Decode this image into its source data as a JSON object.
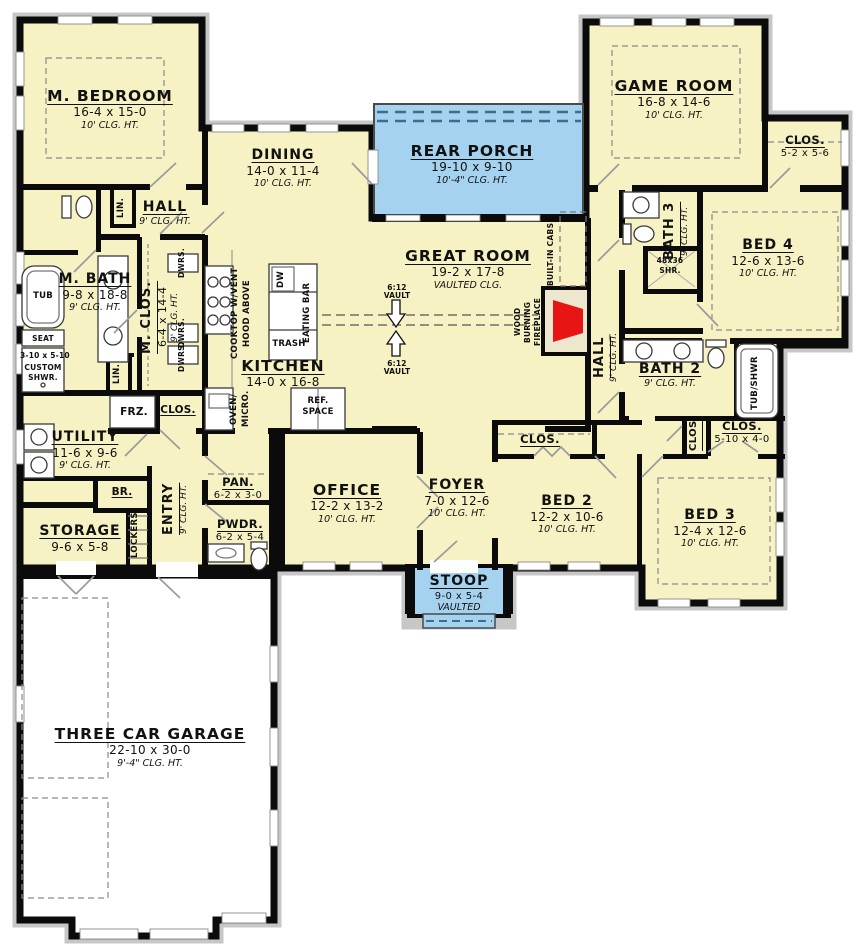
{
  "palette": {
    "background": "#ffffff",
    "floor": "#f6f2c3",
    "porch": "#a5d2ef",
    "wall": "#0b0b0b",
    "fireplace_red": "#e81515",
    "hearth": "#ece7cd",
    "door_line": "#9a9a9a",
    "exterior_floor": "#ffffff",
    "siding": "#c7c7c7"
  },
  "rooms": {
    "m_bedroom": {
      "name": "M. BEDROOM",
      "dims": "16-4 x 15-0",
      "clg": "10' CLG. HT."
    },
    "dining": {
      "name": "DINING",
      "dims": "14-0 x 11-4",
      "clg": "10' CLG. HT."
    },
    "rear_porch": {
      "name": "REAR PORCH",
      "dims": "19-10 x 9-10",
      "clg": "10'-4\" CLG. HT."
    },
    "game_room": {
      "name": "GAME ROOM",
      "dims": "16-8 x 14-6",
      "clg": "10' CLG. HT."
    },
    "clos_game": {
      "name": "CLOS.",
      "dims": "5-2 x 5-6"
    },
    "bed4": {
      "name": "BED 4",
      "dims": "12-6 x 13-6",
      "clg": "10' CLG. HT."
    },
    "bath3": {
      "name": "BATH 3",
      "clg": "9' CLG. HT."
    },
    "great_room": {
      "name": "GREAT ROOM",
      "dims": "19-2 x 17-8",
      "clg": "VAULTED CLG."
    },
    "hall_upper": {
      "name": "HALL",
      "clg": "9' CLG. HT."
    },
    "m_bath": {
      "name": "M. BATH",
      "dims": "9-8 x 18-8",
      "clg": "9' CLG. HT."
    },
    "m_clos": {
      "name": "M. CLOS.",
      "dims": "6-4 x 14-4",
      "clg": "9' CLG. HT."
    },
    "kitchen": {
      "name": "KITCHEN",
      "dims": "14-0 x 16-8"
    },
    "utility": {
      "name": "UTILITY",
      "dims": "11-6 x 9-6",
      "clg": "9' CLG. HT."
    },
    "storage": {
      "name": "STORAGE",
      "dims": "9-6 x 5-8"
    },
    "entry": {
      "name": "ENTRY",
      "clg": "9' CLG. HT."
    },
    "pantry": {
      "name": "PAN.",
      "dims": "6-2 x 3-0"
    },
    "powder": {
      "name": "PWDR.",
      "dims": "6-2 x 5-4"
    },
    "office": {
      "name": "OFFICE",
      "dims": "12-2 x 13-2",
      "clg": "10' CLG. HT."
    },
    "foyer": {
      "name": "FOYER",
      "dims": "7-0 x 12-6",
      "clg": "10' CLG. HT."
    },
    "stoop": {
      "name": "STOOP",
      "dims": "9-0 x 5-4",
      "clg": "VAULTED"
    },
    "bed2": {
      "name": "BED 2",
      "dims": "12-2 x 10-6",
      "clg": "10' CLG. HT."
    },
    "bed3": {
      "name": "BED 3",
      "dims": "12-4 x 12-6",
      "clg": "10' CLG. HT."
    },
    "bath2": {
      "name": "BATH 2",
      "clg": "9' CLG. HT."
    },
    "hall_bed": {
      "name": "HALL",
      "clg": "9' CLG. HT."
    },
    "clos_bed2": {
      "name": "CLOS."
    },
    "clos_hall": {
      "name": "CLOS."
    },
    "clos_bed3": {
      "name": "CLOS.",
      "dims": "5-10 x 4-0"
    },
    "garage": {
      "name": "THREE CAR GARAGE",
      "dims": "22-10 x 30-0",
      "clg": "9'-4\" CLG. HT."
    }
  },
  "fixtures": {
    "tub": "TUB",
    "seat": "SEAT",
    "shwr_dims": "3-10 x 5-10",
    "custom_line1": "CUSTOM",
    "custom_line2": "SHWR.",
    "linen": "LIN.",
    "drawers": "DWRS.",
    "freezer": "FRZ.",
    "closet": "CLOS.",
    "broom": "BR.",
    "lockers": "LOCKERS",
    "cooktop_line1": "COOKTOP W/VENT",
    "cooktop_line2": "HOOD ABOVE",
    "oven_line1": "OVEN/",
    "oven_line2": "MICRO.",
    "dishwasher": "DW",
    "trash": "TRASH",
    "eating_bar": "EATING BAR",
    "ref_line1": "REF.",
    "ref_line2": "SPACE",
    "vault_ratio": "6:12",
    "vault_word": "VAULT",
    "fireplace_line1": "WOOD",
    "fireplace_line2": "BURNING",
    "fireplace_line3": "FIREPLACE",
    "builtin_cabs": "BUILT-IN CABS",
    "shower_line1": "48x36",
    "shower_line2": "SHR.",
    "tub_shwr": "TUB/SHWR"
  }
}
